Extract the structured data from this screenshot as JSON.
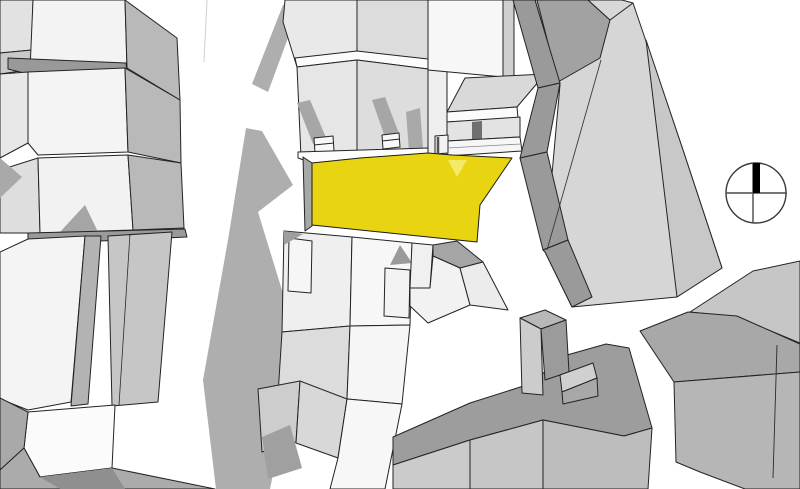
{
  "canvas": {
    "width": 800,
    "height": 489,
    "background": "#ffffff"
  },
  "style": {
    "outline_color": "#232323",
    "outline_width": 1,
    "highlight_color": "#e9d411",
    "highlight_light": "#f3ea67",
    "shadow_color": "#aeaeae"
  },
  "compass": {
    "cx": 756,
    "cy": 193,
    "r": 30,
    "ring_color": "#3a3a3a",
    "ring_width": 1.4,
    "cross_color": "#4a4a4a",
    "cross_width": 1.4,
    "h_line": {
      "x1": 726,
      "y1": 193,
      "x2": 787,
      "y2": 193
    },
    "v_line": {
      "x1": 753,
      "y1": 163,
      "x2": 753,
      "y2": 223
    },
    "needle_points": "753,163 760,163 760,193 753,193",
    "needle_color": "#000000"
  },
  "polygons": [
    {
      "name": "shadow-street-upper",
      "points": "283,5 302,0 268,92 252,84",
      "fill": "#aeaeae",
      "stroke": "none"
    },
    {
      "name": "shadow-street-main",
      "points": "246,128 262,131 293,185 258,212 285,300 292,380 270,489 216,489 203,380 228,240",
      "fill": "#aeaeae",
      "stroke": "none"
    },
    {
      "name": "left-block-col-top",
      "points": "0,0 33,0 32,50 0,53",
      "fill": "#e2e2e2",
      "stroke": "edge"
    },
    {
      "name": "left-block-col-mid",
      "points": "0,53 32,50 28,70 0,74",
      "fill": "#c9c9c9",
      "stroke": "edge"
    },
    {
      "name": "left-block-row1-roof",
      "points": "33,0 125,0 127,68 30,70",
      "fill": "#f3f3f3",
      "stroke": "edge"
    },
    {
      "name": "left-block-row1-side",
      "points": "125,0 177,38 180,100 127,68",
      "fill": "#b9b9b9",
      "stroke": "edge"
    },
    {
      "name": "left-block-gap-band",
      "points": "8,58 126,63 127,72 28,74 8,69",
      "fill": "#999999",
      "stroke": "edge"
    },
    {
      "name": "left-block-row2-left",
      "points": "0,74 28,72 28,143 0,158",
      "fill": "#e8e8e8",
      "stroke": "edge"
    },
    {
      "name": "left-block-row2-roof",
      "points": "28,72 125,68 128,152 38,155 28,143",
      "fill": "#f4f4f4",
      "stroke": "edge"
    },
    {
      "name": "left-block-row2-side",
      "points": "125,68 180,100 181,163 128,152",
      "fill": "#b9b9b9",
      "stroke": "edge"
    },
    {
      "name": "left-block-row3-left",
      "points": "0,170 38,158 40,233 0,233",
      "fill": "#dedede",
      "stroke": "edge"
    },
    {
      "name": "left-block-dark-tri",
      "points": "0,158 22,177 0,198",
      "fill": "#a9a9a9",
      "stroke": "none"
    },
    {
      "name": "left-block-row3-roof",
      "points": "38,158 128,155 133,230 40,233",
      "fill": "#f2f2f2",
      "stroke": "edge"
    },
    {
      "name": "left-block-row3-side",
      "points": "128,155 181,163 184,228 133,230",
      "fill": "#b9b9b9",
      "stroke": "edge"
    },
    {
      "name": "left-block-row3-shadow",
      "points": "60,232 85,205 98,232",
      "fill": "#a5a5a5",
      "stroke": "none"
    },
    {
      "name": "left-block-bottom-band",
      "points": "28,233 185,229 187,237 100,241 28,239",
      "fill": "#9a9a9a",
      "stroke": "edge"
    },
    {
      "name": "left-lower-west-face",
      "points": "0,252 28,239 85,236 71,402 28,410 0,399",
      "fill": "#f4f4f4",
      "stroke": "edge"
    },
    {
      "name": "left-lower-strip-a",
      "points": "85,236 101,236 88,404 71,406",
      "fill": "#b3b3b3",
      "stroke": "edge"
    },
    {
      "name": "left-lower-strip-b",
      "points": "108,236 172,232 158,402 112,406",
      "fill": "#c6c6c6",
      "stroke": "edge"
    },
    {
      "name": "left-lower-notch",
      "points": "28,412 115,405 112,468 40,477 24,448",
      "fill": "#fbfbfb",
      "stroke": "edge"
    },
    {
      "name": "left-lower-west-wedge",
      "points": "0,398 28,412 24,448 0,470",
      "fill": "#a9a9a9",
      "stroke": "edge"
    },
    {
      "name": "left-lower-bottom-band",
      "points": "24,448 40,477 112,468 215,489 0,489 0,470",
      "fill": "#ababab",
      "stroke": "edge"
    },
    {
      "name": "left-lower-bottom-dark",
      "points": "40,477 112,468 125,489 60,489",
      "fill": "#8f8f8f",
      "stroke": "none"
    },
    {
      "name": "north-row-roof-left",
      "points": "283,22 285,0 357,0 357,57 297,67",
      "fill": "#e9e9e9",
      "stroke": "edge"
    },
    {
      "name": "north-row-roof-right",
      "points": "357,0 428,0 428,60 357,57",
      "fill": "#dcdcdc",
      "stroke": "edge"
    },
    {
      "name": "north-row-eaves",
      "points": "295,58 357,51 428,59 428,69 357,60 297,67",
      "fill": "#fcfcfc",
      "stroke": "edge"
    },
    {
      "name": "north-row-facade-left",
      "points": "297,67 357,60 357,153 301,157",
      "fill": "#e6e6e6",
      "stroke": "edge"
    },
    {
      "name": "north-row-facade-right",
      "points": "357,60 428,69 428,150 357,153",
      "fill": "#dddddd",
      "stroke": "edge"
    },
    {
      "name": "chimney-shadow-1",
      "points": "297,103 310,100 327,140 313,144",
      "fill": "#a6a6a6",
      "stroke": "none"
    },
    {
      "name": "chimney-shadow-2",
      "points": "372,100 385,97 400,136 386,140",
      "fill": "#a6a6a6",
      "stroke": "none"
    },
    {
      "name": "chimney-shadow-3",
      "points": "406,112 420,108 423,148 409,151",
      "fill": "#a9a9a9",
      "stroke": "none"
    },
    {
      "name": "chimney-1",
      "points": "314,138 333,136 334,151 315,153",
      "fill": "#f8f8f8",
      "stroke": "edge"
    },
    {
      "name": "chimney-2",
      "points": "382,135 399,133 400,147 383,149",
      "fill": "#f8f8f8",
      "stroke": "edge"
    },
    {
      "name": "north-row-filler-strip",
      "points": "428,69 447,71 447,156 428,159",
      "fill": "#efefef",
      "stroke": "edge"
    },
    {
      "name": "north-row-building-east",
      "points": "428,0 503,0 503,77 428,70",
      "fill": "#f7f7f7",
      "stroke": "edge"
    },
    {
      "name": "north-row-wedge-east",
      "points": "503,0 514,0 514,76 503,77",
      "fill": "#cfcfcf",
      "stroke": "edge"
    },
    {
      "name": "north-row-roof-slope-east",
      "points": "465,78 545,74 517,107 447,112",
      "fill": "#d9d9d9",
      "stroke": "edge"
    },
    {
      "name": "north-row-eaves-east",
      "points": "447,112 517,107 518,118 447,122",
      "fill": "#fbfbfb",
      "stroke": "edge"
    },
    {
      "name": "north-row-facade-east",
      "points": "447,122 520,117 520,137 447,141",
      "fill": "#e3e3e3",
      "stroke": "edge"
    },
    {
      "name": "north-row-door-east",
      "points": "472,122 482,121 482,148 472,149",
      "fill": "#6f6f6f",
      "stroke": "none"
    },
    {
      "name": "north-row-curb-east",
      "points": "447,141 520,137 522,151 447,156",
      "fill": "#f6f6f6",
      "stroke": "edge"
    },
    {
      "name": "small-roof-box",
      "points": "435,136 448,135 448,153 435,154",
      "fill": "#f2f2f2",
      "stroke": "edge"
    },
    {
      "name": "sidewalk-west",
      "points": "298,152 428,148 428,159 312,163 298,158",
      "fill": "#fdfdfd",
      "stroke": "edge"
    },
    {
      "name": "parcel-west-sliver",
      "points": "303,157 312,163 312,226 305,231",
      "fill": "#a8a8a8",
      "stroke": "edge"
    },
    {
      "name": "highlighted-parcel",
      "points": "312,163 360,158 428,153 452,155 512,158 480,205 477,242 312,225",
      "fill": "#e9d411",
      "stroke": "#1a1a1a",
      "interactable": true
    },
    {
      "name": "parcel-notch-triangle",
      "points": "448,160 467,160 457,177",
      "fill": "#f3ea67",
      "stroke": "none"
    },
    {
      "name": "east-building-base",
      "points": "535,0 590,0 633,3 683,150 722,268 677,297 572,307 545,252 560,85",
      "fill": "#d6d6d6",
      "stroke": "edge"
    },
    {
      "name": "east-building-right-face",
      "points": "646,40 683,150 722,268 677,297",
      "fill": "#c8c8c8",
      "stroke": "edge"
    },
    {
      "name": "east-building-top-dark",
      "points": "537,0 588,0 610,20 600,58 558,82",
      "fill": "#a2a2a2",
      "stroke": "edge"
    },
    {
      "name": "east-building-top-light",
      "points": "588,0 622,0 633,3 610,20",
      "fill": "#d8d8d8",
      "stroke": "edge"
    },
    {
      "name": "ne-wall-band-1",
      "points": "513,0 535,0 560,83 538,88",
      "fill": "#9a9a9a",
      "stroke": "edge"
    },
    {
      "name": "ne-wall-band-2",
      "points": "538,88 560,83 547,152 520,158",
      "fill": "#9a9a9a",
      "stroke": "edge"
    },
    {
      "name": "ne-wall-band-3",
      "points": "520,158 547,152 568,240 543,250",
      "fill": "#9a9a9a",
      "stroke": "edge"
    },
    {
      "name": "ne-wall-band-4",
      "points": "543,250 568,240 592,297 572,307 545,252",
      "fill": "#9a9a9a",
      "stroke": "edge"
    },
    {
      "name": "south-row-house-1",
      "points": "284,231 352,237 350,326 282,332",
      "fill": "#efefef",
      "stroke": "edge"
    },
    {
      "name": "south-row-dormer-1",
      "points": "289,238 312,241 311,293 288,291",
      "fill": "#f6f6f6",
      "stroke": "edge"
    },
    {
      "name": "south-row-corner-shadow",
      "points": "284,231 303,234 284,245",
      "fill": "#9e9e9e",
      "stroke": "none"
    },
    {
      "name": "south-row-house-2",
      "points": "352,237 412,243 410,325 350,326",
      "fill": "#f7f7f7",
      "stroke": "edge"
    },
    {
      "name": "south-row-dormer-2",
      "points": "385,268 410,270 409,318 384,316",
      "fill": "#f3f3f3",
      "stroke": "edge"
    },
    {
      "name": "south-row-gable-shadow",
      "points": "390,265 400,245 412,263",
      "fill": "#9a9a9a",
      "stroke": "none"
    },
    {
      "name": "south-row-house-3",
      "points": "412,243 433,245 430,288 410,288",
      "fill": "#f0f0f0",
      "stroke": "edge"
    },
    {
      "name": "south-row-sliver",
      "points": "433,245 457,241 483,262 460,268 433,256",
      "fill": "#a5a5a5",
      "stroke": "edge"
    },
    {
      "name": "south-row-house-4",
      "points": "410,288 430,288 433,256 460,268 470,305 428,323 410,306",
      "fill": "#f2f2f2",
      "stroke": "edge"
    },
    {
      "name": "south-row-house-5",
      "points": "460,268 483,262 508,310 470,305",
      "fill": "#ececec",
      "stroke": "edge"
    },
    {
      "name": "south-row-lower-left",
      "points": "282,332 350,326 347,399 300,386 278,395",
      "fill": "#dcdcdc",
      "stroke": "edge"
    },
    {
      "name": "south-row-lower-right",
      "points": "350,326 410,325 402,404 347,399",
      "fill": "#f6f6f6",
      "stroke": "edge"
    },
    {
      "name": "bottom-center-facet-1",
      "points": "258,389 300,381 296,442 262,452",
      "fill": "#cdcdcd",
      "stroke": "edge"
    },
    {
      "name": "bottom-center-shadow",
      "points": "262,437 290,425 302,468 268,479",
      "fill": "#a0a0a0",
      "stroke": "none"
    },
    {
      "name": "bottom-center-facet-2",
      "points": "300,381 347,399 338,458 296,443",
      "fill": "#d8d8d8",
      "stroke": "edge"
    },
    {
      "name": "bottom-center-facet-3",
      "points": "347,399 402,404 385,489 330,489 338,458",
      "fill": "#f7f7f7",
      "stroke": "edge"
    },
    {
      "name": "se-cluster-band",
      "points": "393,437 470,403 533,383 560,357 606,344 629,348 652,428 624,436 543,420 470,440 393,465",
      "fill": "#9d9d9d",
      "stroke": "edge"
    },
    {
      "name": "se-cluster-front-left",
      "points": "393,465 470,440 470,489 393,489",
      "fill": "#cbcbcb",
      "stroke": "edge"
    },
    {
      "name": "se-cluster-front-mid",
      "points": "470,440 543,420 543,489 470,489",
      "fill": "#c6c6c6",
      "stroke": "edge"
    },
    {
      "name": "se-cluster-front-right",
      "points": "543,420 624,436 652,428 648,489 543,489",
      "fill": "#bdbdbd",
      "stroke": "edge"
    },
    {
      "name": "se-tower-top",
      "points": "520,318 545,310 566,320 541,329",
      "fill": "#b8b8b8",
      "stroke": "edge"
    },
    {
      "name": "se-tower-front",
      "points": "520,318 541,329 543,395 522,393",
      "fill": "#cccccc",
      "stroke": "edge"
    },
    {
      "name": "se-tower-side",
      "points": "541,329 566,320 569,372 545,380",
      "fill": "#9b9b9b",
      "stroke": "edge"
    },
    {
      "name": "se-tower-base-top",
      "points": "560,375 593,363 597,378 562,392",
      "fill": "#d0d0d0",
      "stroke": "edge"
    },
    {
      "name": "se-tower-base-front",
      "points": "562,392 597,378 598,396 563,404",
      "fill": "#a8a8a8",
      "stroke": "edge"
    },
    {
      "name": "far-right-roof-light",
      "points": "753,271 800,261 800,343 737,317 690,312",
      "fill": "#c6c6c6",
      "stroke": "edge"
    },
    {
      "name": "far-right-band",
      "points": "640,331 688,312 737,316 800,344 800,372 674,382",
      "fill": "#a8a8a8",
      "stroke": "edge"
    },
    {
      "name": "far-right-front",
      "points": "674,382 800,372 800,489 745,489 700,472 676,462",
      "fill": "#b6b6b6",
      "stroke": "edge"
    }
  ],
  "lines": [
    {
      "name": "street-curb-line",
      "x1": 207,
      "y1": 0,
      "x2": 204,
      "y2": 62,
      "color": "#cfcfcf",
      "w": 1
    },
    {
      "name": "strip-b-inner-edge",
      "x1": 130,
      "y1": 234,
      "x2": 119,
      "y2": 405,
      "color": "#2a2a2a",
      "w": 0.8
    },
    {
      "name": "east-building-ground-edge",
      "x1": 601,
      "y1": 60,
      "x2": 547,
      "y2": 250,
      "color": "#3a3a3a",
      "w": 0.9
    },
    {
      "name": "chimney-1-cap-line",
      "x1": 314,
      "y1": 145,
      "x2": 334,
      "y2": 143,
      "color": "#232323",
      "w": 0.9
    },
    {
      "name": "chimney-2-cap-line",
      "x1": 382,
      "y1": 141,
      "x2": 400,
      "y2": 139,
      "color": "#232323",
      "w": 0.9
    },
    {
      "name": "small-box-dark-edge",
      "x1": 438,
      "y1": 137,
      "x2": 438,
      "y2": 153,
      "color": "#555555",
      "w": 2.5
    },
    {
      "name": "curb-step-line",
      "x1": 447,
      "y1": 148,
      "x2": 521,
      "y2": 144,
      "color": "#888888",
      "w": 0.8
    },
    {
      "name": "far-right-facet-line",
      "x1": 777,
      "y1": 345,
      "x2": 773,
      "y2": 478,
      "color": "#2a2a2a",
      "w": 0.9
    }
  ]
}
